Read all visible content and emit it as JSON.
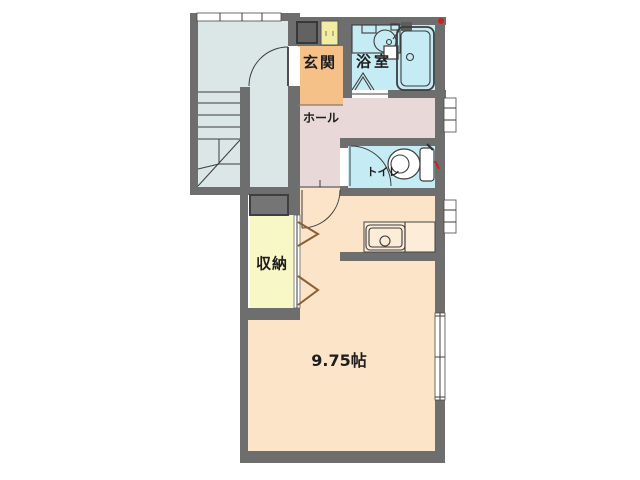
{
  "document": {
    "kind": "apartment floor plan"
  },
  "rooms": {
    "entrance": {
      "label": "玄関"
    },
    "bathroom": {
      "label": "浴室"
    },
    "hall": {
      "label": "ホール"
    },
    "toilet": {
      "label": "トイレ"
    },
    "storage": {
      "label": "収納"
    },
    "living": {
      "label": "9.75帖",
      "area_tatami": 9.75
    }
  },
  "icons": {
    "stairs": "stairs-icon",
    "bathtub": "bathtub-icon",
    "washbasin": "washbasin-icon",
    "toilet": "toilet-icon",
    "kitchen_sink": "kitchen-sink-icon",
    "shoe_cabinet": "shoe-cabinet-icon",
    "door_swing": "door-swing-arc-icon",
    "folding_door": "folding-door-icon",
    "window": "window-icon",
    "marker": "red-marker-dot"
  },
  "colors": {
    "wall": "#6e6e6e",
    "stairwell": "#dbe7e6",
    "wet_room": "#c5ebf4",
    "entrance": "#f6c189",
    "hall": "#e8d8d8",
    "storage": "#f8f8c6",
    "living": "#fce4c8",
    "counter": "#fdecd8",
    "shoe_cabinet": "#f2eda2",
    "gray_box": "#757575",
    "door_brown": "#8a6133",
    "marker_red": "#cc2222",
    "line": "#3c3c3c"
  }
}
